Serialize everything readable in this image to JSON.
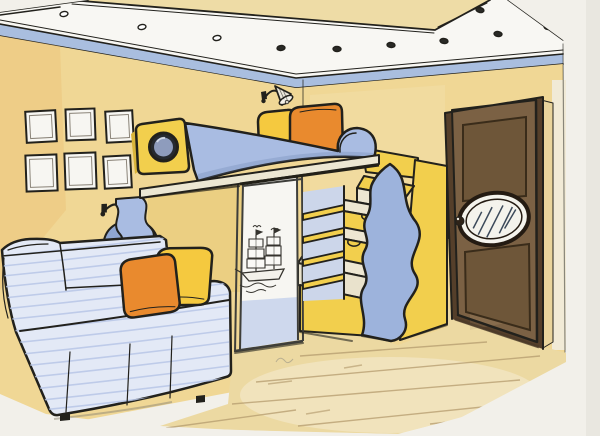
{
  "colors": {
    "paper": "#f2f0ea",
    "paper_shade": "#dcd9d2",
    "ink": "#22211c",
    "wall": "#f0d795",
    "wall_warm": "#e7ae55",
    "tray": "#eedca6",
    "soffit": "#f8f7f3",
    "crown": "#a9bedf",
    "spotlight_dark": "#2a2a26",
    "frame_white": "#f7f6f2",
    "frame_inner": "#8a8378",
    "furniture_yellow": "#f2cf4d",
    "furniture_yellow_deep": "#d9b43a",
    "furniture_blue": "#a9bce2",
    "furniture_blue_deep": "#8fa6d2",
    "wave_blue": "#9db3dc",
    "tread": "#eee7d2",
    "board": "#ece7d3",
    "nook": "#ebcf82",
    "pillow_orange": "#e98a2e",
    "pillow_yellow": "#f5c93f",
    "sofa": "#e3e9f6",
    "sofa_stripe": "#b7c5e6",
    "door_brown": "#7b6144",
    "door_brown_dark": "#553f2a",
    "door_jamb": "#e9d49c",
    "glass_white": "#f4f3ec",
    "porthole_dark": "#262a30",
    "porthole_glass": "#8e9cbd",
    "shelf_back": "#ccd6ea",
    "wardrobe_lower": "#c9d5ec",
    "metal_frame": "#3e3e3a",
    "floor": "#ecd9a2",
    "floor_line": "#b59c6e",
    "lamp_shade": "#eae6da",
    "ship_ink": "#35332e"
  },
  "scene": {
    "description": "Hand-drawn marker and colored-pencil sketch of a children's bedroom: tray ceiling with spotlights, loft bed with porthole headboard and stair drawers, ship-art sliding wardrobe, striped sofa with pillows, wooden door with oval window.",
    "ceiling": {
      "spotlights": [
        {
          "x": 64,
          "y": 14,
          "rot": -10,
          "filled": 0
        },
        {
          "x": 142,
          "y": 27,
          "rot": -10,
          "filled": 0
        },
        {
          "x": 217,
          "y": 38,
          "rot": -9,
          "filled": 0
        },
        {
          "x": 281,
          "y": 48,
          "rot": -6,
          "filled": 1
        },
        {
          "x": 337,
          "y": 49,
          "rot": 3,
          "filled": 1
        },
        {
          "x": 391,
          "y": 45,
          "rot": 6,
          "filled": 1
        },
        {
          "x": 444,
          "y": 41,
          "rot": 7,
          "filled": 1
        },
        {
          "x": 498,
          "y": 34,
          "rot": 8,
          "filled": 1
        },
        {
          "x": 548,
          "y": 27,
          "rot": 9,
          "filled": 1
        },
        {
          "x": 480,
          "y": 10,
          "rot": 12,
          "filled": 1
        }
      ]
    },
    "left_wall": {
      "picture_frames": [
        {
          "x": 26,
          "y": 111,
          "w": 30,
          "h": 31,
          "rot": -3
        },
        {
          "x": 66,
          "y": 109,
          "w": 29,
          "h": 31,
          "rot": -2
        },
        {
          "x": 106,
          "y": 111,
          "w": 27,
          "h": 31,
          "rot": -3
        },
        {
          "x": 26,
          "y": 155,
          "w": 31,
          "h": 36,
          "rot": -2
        },
        {
          "x": 65,
          "y": 153,
          "w": 31,
          "h": 36,
          "rot": -2
        },
        {
          "x": 104,
          "y": 156,
          "w": 27,
          "h": 32,
          "rot": -3
        }
      ]
    },
    "bed_unit": {
      "shelf_boards": [
        [
          214,
          205
        ],
        [
          237,
          228
        ],
        [
          260,
          251
        ],
        [
          283,
          274
        ]
      ],
      "stair_drawer_count": 3,
      "step_count": 4
    },
    "sofa": {
      "stripe_y": [
        256,
        266,
        276,
        287,
        298,
        309,
        320,
        332,
        344,
        356,
        368,
        380,
        392,
        404,
        414
      ],
      "pillow_count": 2
    },
    "floor": {
      "plank_lines": [
        [
          300,
          356,
          487,
          342
        ],
        [
          256,
          382,
          540,
          356
        ],
        [
          232,
          404,
          520,
          380
        ],
        [
          298,
          426,
          560,
          399
        ],
        [
          166,
          428,
          296,
          410
        ],
        [
          430,
          424,
          565,
          409
        ]
      ],
      "dash_lines": [
        [
          268,
          384,
          292,
          381
        ],
        [
          306,
          414,
          330,
          410
        ],
        [
          344,
          368,
          362,
          365
        ]
      ]
    },
    "lamps": [
      {
        "x": 262,
        "y": 89,
        "rot": 0,
        "scale": 1
      },
      {
        "x": 103,
        "y": 201,
        "rot": 8,
        "scale": 1.08
      }
    ],
    "objects": [
      {
        "name": "tray-ceiling",
        "note": "yellow recessed center, white soffit band with 10 spotlights, blue crown molding"
      },
      {
        "name": "picture-frames",
        "count": 6,
        "note": "small empty white frames, 2 rows of 3"
      },
      {
        "name": "wall-sconce",
        "count": 2,
        "note": "cone shade lamps"
      },
      {
        "name": "loft-bed",
        "note": "blue and yellow, porthole headboard, scroll footboard, yellow and orange pillows"
      },
      {
        "name": "wardrobe-sliding-door",
        "note": "white panel with sailing-ship drawing, blue lower third"
      },
      {
        "name": "open-shelves",
        "count": 4,
        "note": "yellow boards on blue back"
      },
      {
        "name": "stairs-with-drawers",
        "note": "cream treads, yellow drawer fronts with notch handles, wavy blue side panel"
      },
      {
        "name": "sofa",
        "note": "pale blue striped slipcover, orange and yellow pillows"
      },
      {
        "name": "wooden-door",
        "note": "brown panel door with tilted oval window and round knob"
      },
      {
        "name": "light-switch",
        "note": "square switch left of door"
      },
      {
        "name": "wood-floor",
        "note": "light tan planks drawn in perspective"
      }
    ]
  }
}
